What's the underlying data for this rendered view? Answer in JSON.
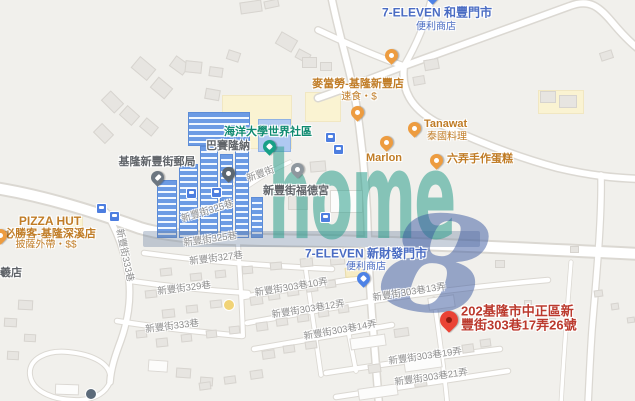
{
  "watermark": {
    "word": "home",
    "digit": "8"
  },
  "marker_address": {
    "line1": "202基隆市中正區新",
    "line2": "豐街303巷17弄26號"
  },
  "pois": {
    "seven_hefeng": {
      "name": "7-ELEVEN 和豐門市",
      "category": "便利商店"
    },
    "mcdonalds": {
      "name": "麥當勞-基隆新豐店",
      "category": "速食・$"
    },
    "tanawat": {
      "name": "Tanawat",
      "category": "泰國料理"
    },
    "marlon": {
      "name": "Marlon"
    },
    "liunong": {
      "name": "六弄手作蛋糕"
    },
    "ocean_univ": {
      "name": "海洋大學世界社區"
    },
    "barcelona": {
      "name": "巴賽隆納"
    },
    "post_office": {
      "name": "基隆新豐街郵局"
    },
    "fudegong": {
      "name": "新豐街福德宮"
    },
    "seven_xincai": {
      "name": "7-ELEVEN 新財發門市",
      "category": "便利商店"
    },
    "pizza_hut": {
      "name": "PIZZA HUT",
      "branch": "必勝客-基隆深溪店",
      "category": "披薩外帶・$$"
    },
    "partial_shop": {
      "name": "羲店"
    }
  },
  "streets": {
    "xinfeng": "新豐街",
    "lane325": "新豐街325巷",
    "lane327": "新豐街327巷",
    "lane329": "新豐街329巷",
    "lane333": "新豐街333巷",
    "alley10": "新豐街303巷10弄",
    "alley12": "新豐街303巷12弄",
    "alley13": "新豐街303巷13弄",
    "alley14": "新豐街303巷14弄",
    "alley19": "新豐街303巷19弄",
    "alley21": "新豐街303巷21弄"
  },
  "colors": {
    "convenience_label": "#4a6cc3",
    "restaurant_label": "#c07c26",
    "community_label": "#0f8a70",
    "street_label": "#8e8e8e",
    "address_label": "#bb3a2e",
    "marker_red": "#ea4335",
    "watermark_teal": "#2c9e8c",
    "watermark_blue": "#3a58a0",
    "highlight_building_blue": "#6c9be4"
  }
}
